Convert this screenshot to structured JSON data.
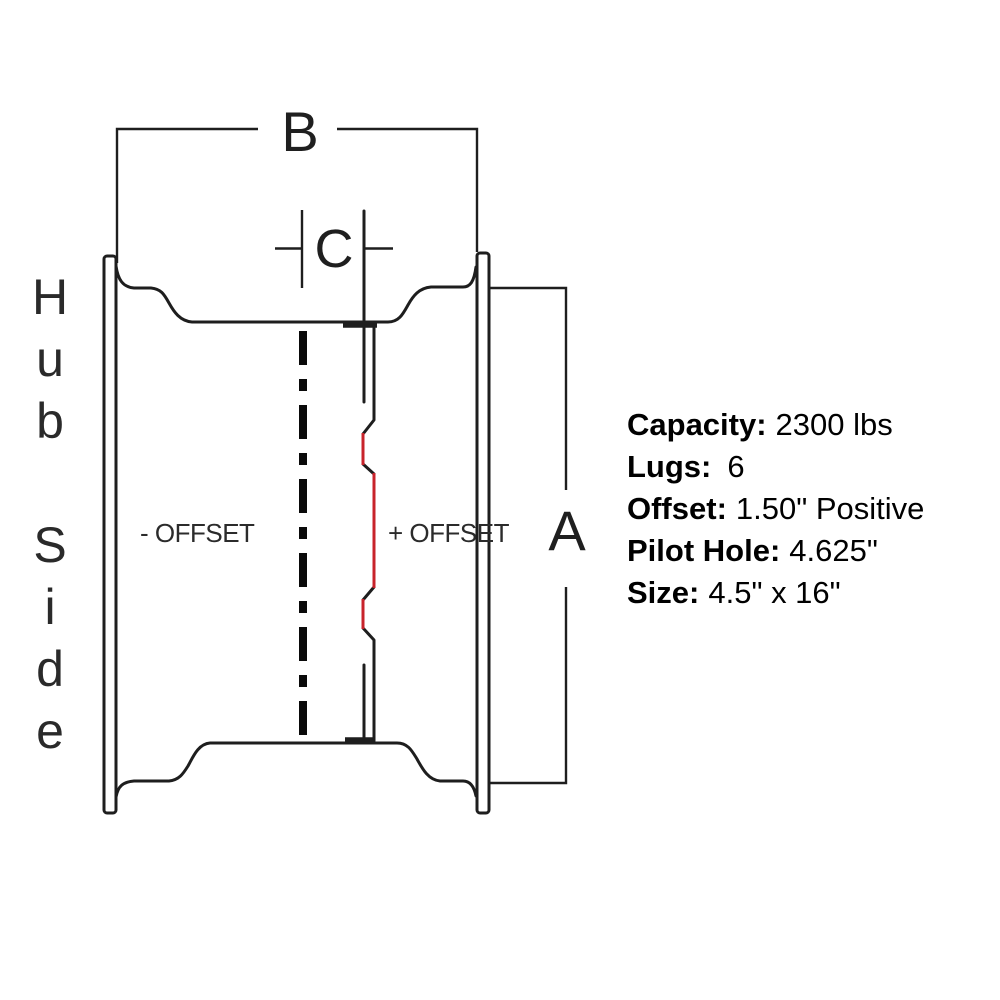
{
  "diagram": {
    "hub_side_label": "Hub Side",
    "dim_a": "A",
    "dim_b": "B",
    "dim_c": "C",
    "neg_offset_label": "- OFFSET",
    "pos_offset_label": "+ OFFSET"
  },
  "colors": {
    "line": "#1e1e1e",
    "accent_red": "#c8232b"
  },
  "specs": {
    "rows": [
      {
        "label": "Capacity:",
        "value": "2300 lbs"
      },
      {
        "label": "Lugs:",
        "value": "6"
      },
      {
        "label": "Offset:",
        "value": "1.50\" Positive"
      },
      {
        "label": "Pilot Hole:",
        "value": "4.625\""
      },
      {
        "label": "Size:",
        "value": "4.5\" x 16\""
      }
    ]
  }
}
